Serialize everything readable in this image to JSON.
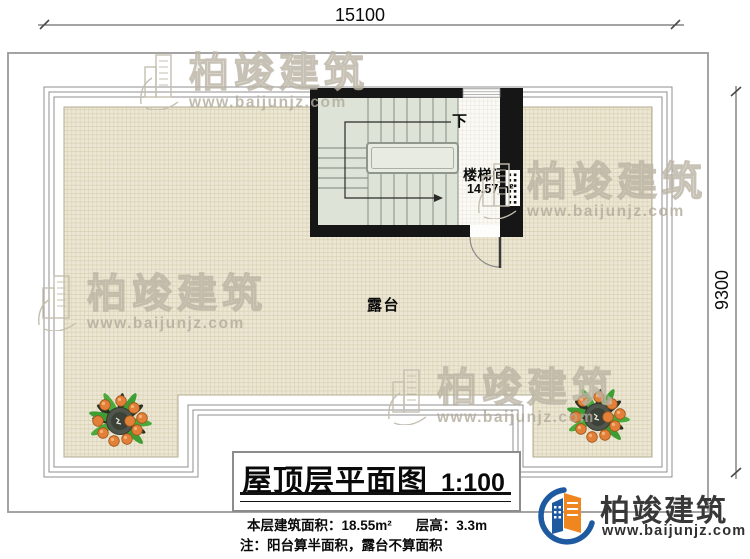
{
  "dimensions": {
    "top": "15100",
    "right": "9300"
  },
  "stairwell": {
    "down_label": "下",
    "room_label": "楼梯间",
    "room_area": "14.57m²"
  },
  "terrace": {
    "label": "露台"
  },
  "title_block": {
    "title": "屋顶层平面图",
    "scale": "1:100",
    "area_text": "本层建筑面积：18.55m²",
    "height_text": "层高：3.3m",
    "note_text": "注：阳台算半面积，露台不算面积"
  },
  "logo": {
    "company": "柏竣建筑",
    "website": "www.baijunjz.com"
  },
  "watermark": {
    "brand": "柏竣建筑",
    "website": "www.baijunjz.com"
  },
  "colors": {
    "wall": "#161616",
    "hatch_bg": "#ece7d4",
    "hatch_line": "#d9d0b2",
    "stair_fill": "#dde3d7",
    "boundary_gray": "#9a9a9a",
    "brand_blue": "#1e5aa0",
    "brand_orange": "#f0861f",
    "plant_green": "#3f9e33",
    "plant_orange": "#e2803a"
  }
}
